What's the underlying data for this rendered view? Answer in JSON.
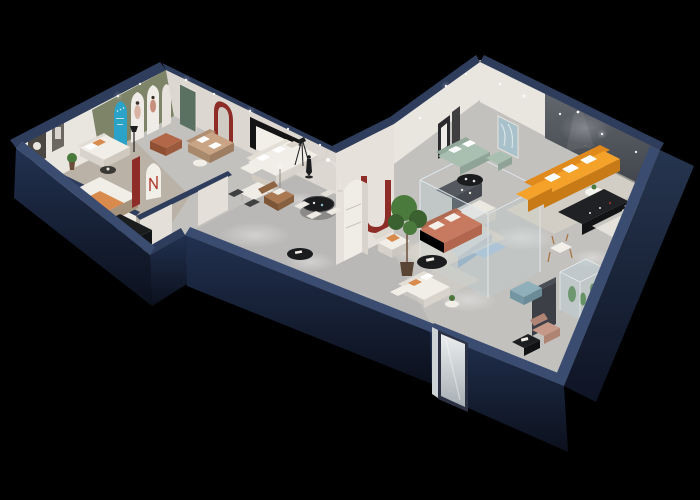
{
  "scene": {
    "description": "isometric-3d-furniture-showroom-floorplan-render",
    "background": "#000000",
    "media_wall_slogan": {
      "line1": "···· ·· ··· ····· ··· ····",
      "line2": "··· ·····"
    }
  },
  "palette": {
    "background": "#000000",
    "wall_rim": "#2e3d5c",
    "wall_rim_light": "#3a4c70",
    "wall_inner": "#e9e5df",
    "wall_inner_shade": "#dcd7d0",
    "floor_light": "#c3c1be",
    "floor_wood": "#b4a694",
    "accent_olive": "#7d8468",
    "accent_teal": "#2ba3c9",
    "accent_red": "#8e2d27",
    "door_green": "#5a7060",
    "sofa_white": "#f1eee8",
    "sofa_orange": "#f5a22b",
    "sofa_sage": "#a9bfb0",
    "sofa_salmon": "#c87a60",
    "sofa_blue": "#b4c9dc",
    "sofa_tan": "#c9a585",
    "chair_leather": "#aa7952",
    "chair_blush": "#c59887",
    "bench_copper": "#b26848",
    "bench_blue": "#8fb0bb",
    "pillow_orange": "#d98a4d",
    "furniture_black": "#1b1c1e",
    "rug_cream": "#ded8cb",
    "rug_white": "#eae7e0",
    "runner_dark": "#56544f",
    "plant_green": "#4a7a3c",
    "glass_tint": "#bcd6e0",
    "teddy_brown": "#8a5a3b"
  },
  "objects": {
    "left_wing": [
      "bed-display",
      "wall-shelf",
      "black-console",
      "white-sofa",
      "copper-bench",
      "arch-display-banners",
      "green-door",
      "red-arch-mirror",
      "tan-sofa",
      "white-sectional",
      "white-dining-table",
      "black-round-dining-table",
      "leather-armchair",
      "corridor-runner-rug",
      "red-banner-display",
      "arch-display-n",
      "sculpture-figure",
      "tripod-spotlight"
    ],
    "connector": [
      "red-u-display",
      "white-column"
    ],
    "right_wing": [
      "sage-sofa",
      "gallery-frames",
      "leaf-art-print",
      "media-wall",
      "orange-sectional",
      "black-media-console",
      "round-coffee-tables",
      "cube-armchair",
      "teddy-bear-figure",
      "accent-chair",
      "glass-display-room",
      "blue-modular-sofa",
      "display-counter",
      "salmon-sofa",
      "white-armchair",
      "potted-tree",
      "white-sectional",
      "blue-bench",
      "glass-vitrine-cacti",
      "blush-armchair",
      "entry-mirror-door"
    ]
  }
}
